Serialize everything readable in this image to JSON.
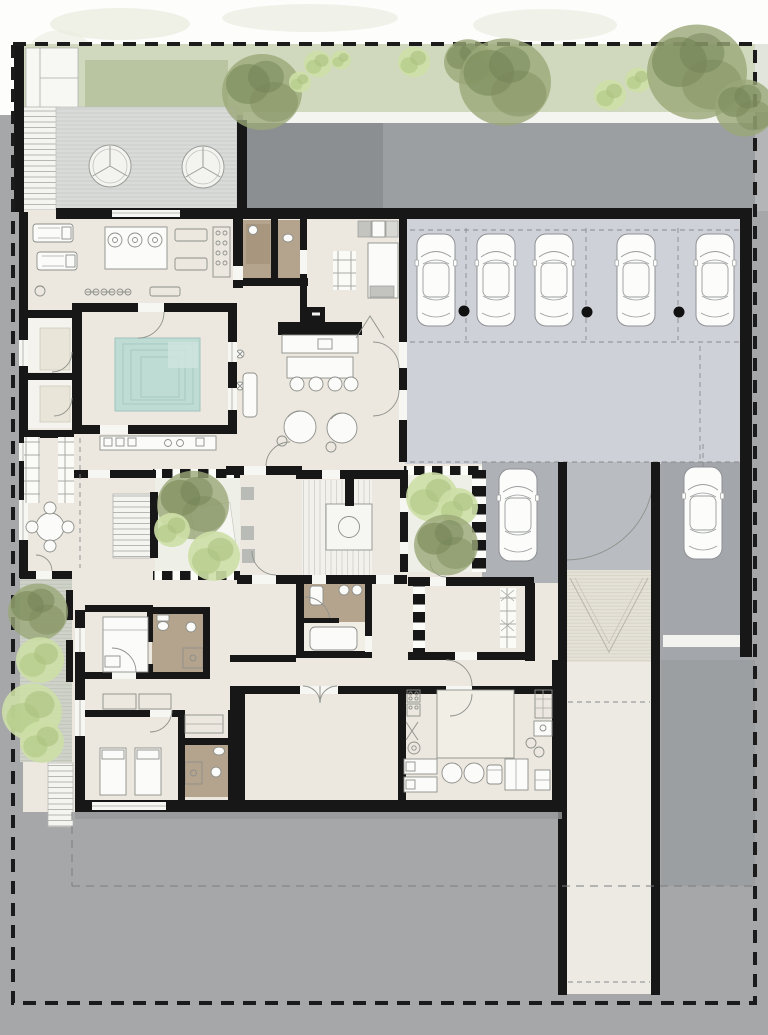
{
  "plan": {
    "type": "architectural-floor-plan",
    "description": "ground floor plan of a villa with spa pool, gym, garage, interior courtyards and service wing",
    "colors": {
      "site": "#a6a7a9",
      "wall": "#171717",
      "floor": "#ece8df",
      "garage": "#ced2d8",
      "road": "#9c9fa2",
      "roofDark": "#8c8f92",
      "court": "#aeb1b5",
      "gate": "#b9bcc0",
      "laneRight": "#a3a6aa",
      "ramp": "#e4e1d7",
      "corridor": "#eceae3",
      "deck": "#d9dbd9",
      "grass": "#d0d9bd",
      "lawn": "#b9c5a0",
      "pave": "#ced2c8",
      "courtFloor": "#eef0e7",
      "pool": "#bedbd4",
      "tan": "#b5a48d",
      "fixture": "#fbfbf9",
      "stroke": "#8d8f8a",
      "treeDark": "#7f8e5e",
      "treeMid": "#9aa878",
      "treeLight": "#c2d59a",
      "boundary": "#1b1b1b"
    },
    "inventory": {
      "garage_cars": 5,
      "court_cars": 2,
      "garage_columns": 3,
      "deck_lounge_chairs": 2,
      "interior_courtyards": 2,
      "side_courtyards": 1,
      "pools": 1,
      "sauna_rooms": 2,
      "bedrooms": 2,
      "beds": 3,
      "dining_chairs": 4,
      "round_service_tables": 2,
      "staircases": 3
    }
  }
}
